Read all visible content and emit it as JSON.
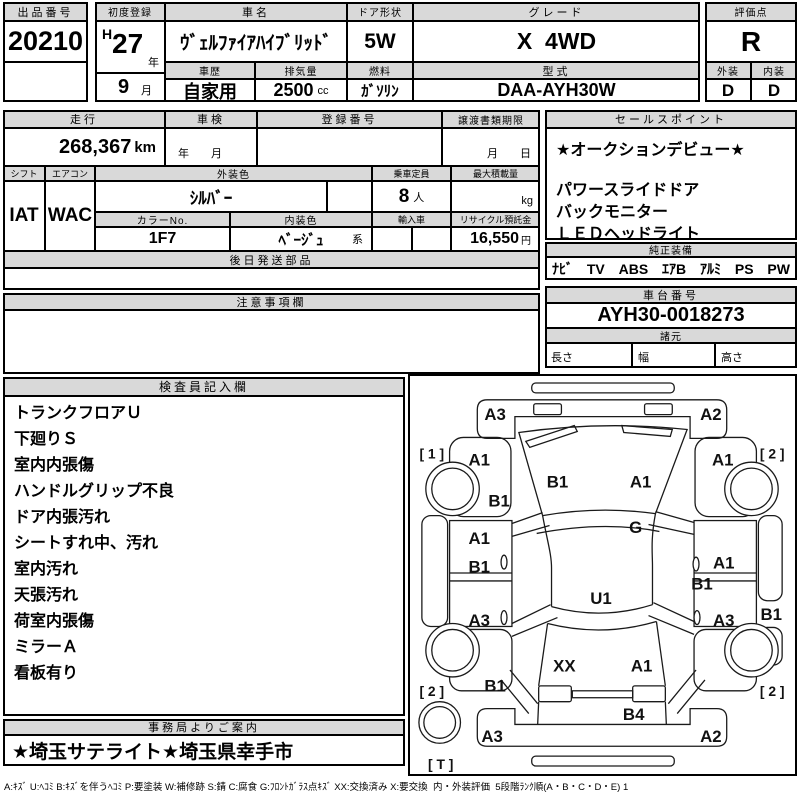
{
  "colors": {
    "header_bg": "#d9d9d9",
    "border": "#000000",
    "paper": "#ffffff"
  },
  "top": {
    "lot_no_label": "出品番号",
    "lot_no": "20210",
    "first_reg_label": "初度登録",
    "first_reg_era": "H",
    "first_reg_year": "27",
    "first_reg_year_unit": "年",
    "first_reg_month": "9",
    "first_reg_month_unit": "月",
    "car_name_label": "車名",
    "car_name": "ｳﾞｪﾙﾌｧｲｱﾊｲﾌﾞﾘｯﾄﾞ",
    "history_label": "車歴",
    "history": "自家用",
    "displacement_label": "排気量",
    "displacement": "2500",
    "displacement_unit": "cc",
    "door_label": "ドア形状",
    "door": "5W",
    "fuel_label": "燃料",
    "fuel": "ｶﾞｿﾘﾝ",
    "grade_label": "グレード",
    "grade": "X  4WD",
    "model_label": "型式",
    "model_code": "DAA-AYH30W",
    "score_label": "評価点",
    "score": "R",
    "exterior_label": "外装",
    "exterior": "D",
    "interior_label": "内装",
    "interior": "D"
  },
  "info": {
    "mileage_label": "走行",
    "mileage": "268,367",
    "mileage_unit": "km",
    "shaken_label": "車検",
    "shaken_placeholder": "年　　月",
    "reg_no_label": "登録番号",
    "reg_no": "",
    "transfer_label": "譲渡書類期限",
    "transfer_placeholder": "月　　日",
    "shift_label": "シフト",
    "shift": "IAT",
    "aircon_label": "エアコン",
    "aircon": "WAC",
    "ext_color_label": "外装色",
    "ext_color": "ｼﾙﾊﾞｰ",
    "capacity_label": "乗車定員",
    "capacity": "8",
    "capacity_unit": "人",
    "max_load_label": "最大積載量",
    "max_load_unit": "kg",
    "color_no_label": "カラーNo.",
    "color_no": "1F7",
    "int_color_label": "内装色",
    "int_color": "ﾍﾞｰｼﾞｭ",
    "int_color_suffix": "系",
    "import_label": "輸入車",
    "recycle_label": "リサイクル預託金",
    "recycle_fee": "16,550",
    "recycle_unit": "円",
    "later_parts_label": "後日発送部品"
  },
  "sales": {
    "label": "セールスポイント",
    "lines": [
      "★オークションデビュー★",
      "パワースライドドア",
      "バックモニター",
      "ＬＥＤヘッドライト"
    ]
  },
  "equip": {
    "label": "純正装備",
    "items": [
      "ﾅﾋﾞ",
      "TV",
      "ABS",
      "ｴｱB",
      "ｱﾙﾐ",
      "PS",
      "PW"
    ]
  },
  "chassis": {
    "label": "車台番号",
    "number": "AYH30-0018273"
  },
  "specs": {
    "label": "諸元",
    "length_label": "長さ",
    "width_label": "幅",
    "height_label": "高さ"
  },
  "caution": {
    "label": "注意事項欄",
    "body": ""
  },
  "inspector": {
    "label": "検査員記入欄",
    "notes": [
      "トランクフロアＵ",
      "下廻りＳ",
      "室内内張傷",
      "ハンドルグリップ不良",
      "ドア内張汚れ",
      "シートすれ中、汚れ",
      "室内汚れ",
      "天張汚れ",
      "荷室内張傷",
      "ミラーＡ",
      "看板有り"
    ]
  },
  "office": {
    "label": "事務局よりご案内",
    "note": "★埼玉サテライト★埼玉県幸手市"
  },
  "diagram": {
    "labels": [
      {
        "text": "A3",
        "x": 86,
        "y": 39
      },
      {
        "text": "A2",
        "x": 304,
        "y": 39
      },
      {
        "text": "[ 1 ]",
        "x": 22,
        "y": 78
      },
      {
        "text": "[ 2 ]",
        "x": 366,
        "y": 78
      },
      {
        "text": "A1",
        "x": 70,
        "y": 85
      },
      {
        "text": "A1",
        "x": 316,
        "y": 85
      },
      {
        "text": "B1",
        "x": 149,
        "y": 107
      },
      {
        "text": "A1",
        "x": 233,
        "y": 107
      },
      {
        "text": "B1",
        "x": 90,
        "y": 126
      },
      {
        "text": "G",
        "x": 228,
        "y": 153
      },
      {
        "text": "A1",
        "x": 70,
        "y": 164
      },
      {
        "text": "B1",
        "x": 70,
        "y": 193
      },
      {
        "text": "A1",
        "x": 317,
        "y": 189
      },
      {
        "text": "B1",
        "x": 295,
        "y": 210
      },
      {
        "text": "A3",
        "x": 70,
        "y": 247
      },
      {
        "text": "A3",
        "x": 317,
        "y": 247
      },
      {
        "text": "B1",
        "x": 365,
        "y": 241
      },
      {
        "text": "U1",
        "x": 193,
        "y": 225
      },
      {
        "text": "B1",
        "x": 86,
        "y": 313
      },
      {
        "text": "[ 2 ]",
        "x": 22,
        "y": 318
      },
      {
        "text": "[ 2 ]",
        "x": 366,
        "y": 318
      },
      {
        "text": "XX",
        "x": 156,
        "y": 293
      },
      {
        "text": "A1",
        "x": 234,
        "y": 293
      },
      {
        "text": "B4",
        "x": 226,
        "y": 342
      },
      {
        "text": "A3",
        "x": 83,
        "y": 364
      },
      {
        "text": "A2",
        "x": 304,
        "y": 364
      },
      {
        "text": "[ T ]",
        "x": 31,
        "y": 392
      }
    ]
  },
  "legend": "A:ｷｽﾞ U:ﾍｺﾐ B:ｷｽﾞを伴うﾍｺﾐ P:要塗装 W:補修跡 S:錆 C:腐食 G:ﾌﾛﾝﾄｶﾞﾗｽ点ｷｽﾞ XX:交換済み X:要交換  内・外装評価  5段階ﾗﾝｸ順(A・B・C・D・E) 1"
}
